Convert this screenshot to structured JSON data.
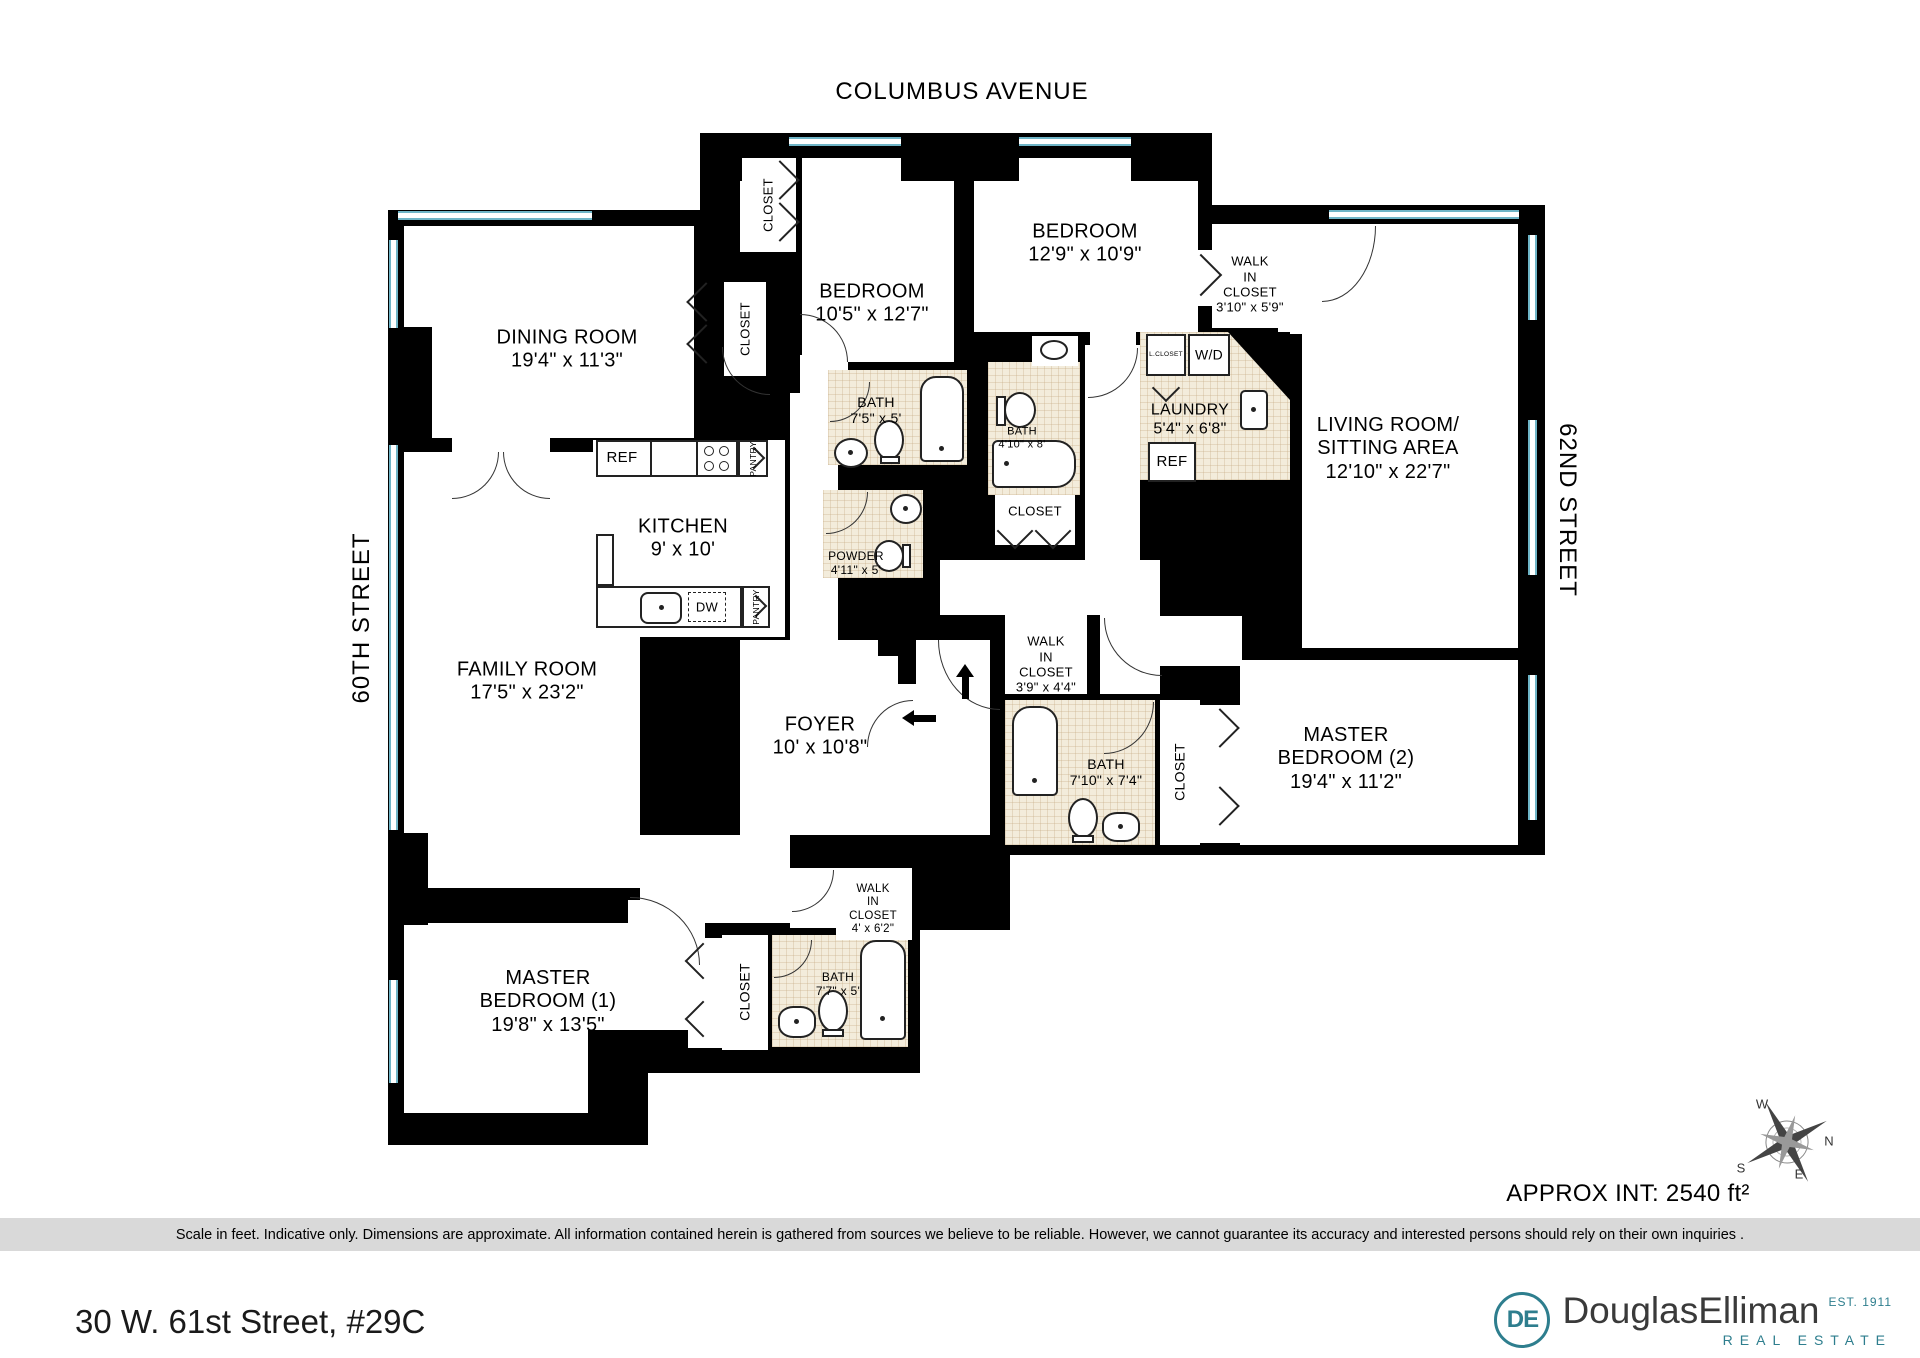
{
  "plan": {
    "street_top": "COLUMBUS AVENUE",
    "street_left": "60TH STREET",
    "street_right": "62ND STREET",
    "rooms": {
      "dining": {
        "name": "DINING ROOM",
        "dims": "19'4\" x 11'3\""
      },
      "bedroom_a": {
        "name": "BEDROOM",
        "dims": "10'5\" x 12'7\""
      },
      "bedroom_b": {
        "name": "BEDROOM",
        "dims": "12'9\" x 10'9\""
      },
      "wic1": {
        "name": "WALK\nIN\nCLOSET",
        "dims": "3'10\" x 5'9\""
      },
      "living": {
        "name": "LIVING ROOM/\nSITTING AREA",
        "dims": "12'10\" x 22'7\""
      },
      "kitchen": {
        "name": "KITCHEN",
        "dims": "9' x 10'"
      },
      "bath1": {
        "name": "BATH",
        "dims": "7'5\" x 5'"
      },
      "bath2": {
        "name": "BATH",
        "dims": "4'10\" x 8'"
      },
      "laundry": {
        "name": "LAUNDRY",
        "dims": "5'4\" x 6'8\""
      },
      "powder": {
        "name": "POWDER",
        "dims": "4'11\" x 5'"
      },
      "family": {
        "name": "FAMILY ROOM",
        "dims": "17'5\" x 23'2\""
      },
      "foyer": {
        "name": "FOYER",
        "dims": "10' x 10'8\""
      },
      "wic2": {
        "name": "WALK\nIN\nCLOSET",
        "dims": "3'9\" x 4'4\""
      },
      "bath3": {
        "name": "BATH",
        "dims": "7'10\" x 7'4\""
      },
      "master2": {
        "name": "MASTER\nBEDROOM (2)",
        "dims": "19'4\" x 11'2\""
      },
      "master1": {
        "name": "MASTER\nBEDROOM (1)",
        "dims": "19'8\" x 13'5\""
      },
      "wic3": {
        "name": "WALK\nIN\nCLOSET",
        "dims": "4' x 6'2\""
      },
      "bath4": {
        "name": "BATH",
        "dims": "7'7\" x 5'"
      }
    },
    "labels": {
      "closet": "CLOSET",
      "ref": "REF",
      "pantry": "PANTRY",
      "dw": "DW",
      "wd": "W/D",
      "lcloset": "L.CLOSET"
    }
  },
  "compass": {
    "n": "N",
    "s": "S",
    "e": "E",
    "w": "W"
  },
  "footer": {
    "approx_area": "APPROX INT: 2540 ft²",
    "disclaimer": "Scale in feet. Indicative only. Dimensions are approximate. All information contained herein is gathered from sources we believe to be reliable. However, we cannot guarantee its accuracy and interested persons should rely on their own inquiries .",
    "address": "30 W. 61st Street, #29C",
    "logo": {
      "monogram": "DE",
      "name": "DouglasElliman",
      "est": "EST. 1911",
      "tagline": "REAL ESTATE"
    }
  }
}
